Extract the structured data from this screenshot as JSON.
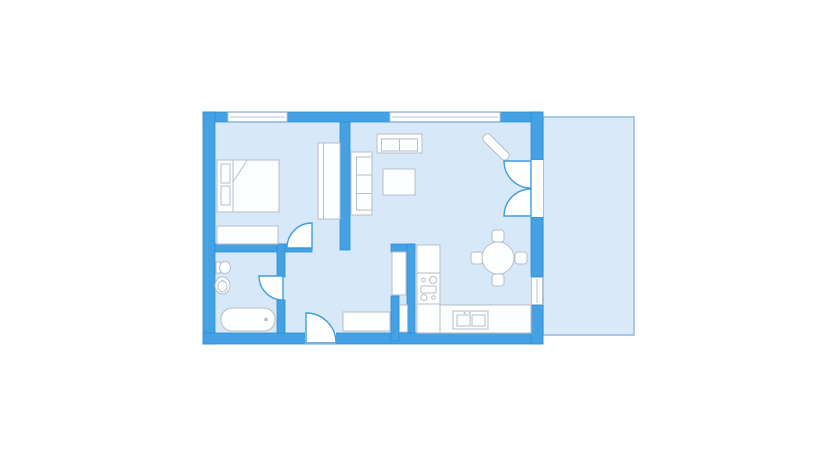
{
  "canvas": {
    "width": 834,
    "height": 460,
    "background": "#ffffff"
  },
  "palette": {
    "wall": "#45a1e1",
    "wallStroke": "#2b90d9",
    "floor": "#d7e9f8",
    "balconyFill": "#dbeaf9",
    "balconyStroke": "#93b7db",
    "white": "#ffffff",
    "furnFill": "#fdfefe",
    "furnStroke": "#b6bec9",
    "windowStroke": "#b3c3d4",
    "doorStroke": "#3f9cde"
  },
  "plan": {
    "elements": [
      {
        "kind": "rect",
        "name": "balcony-floor",
        "fill": "balconyFill",
        "stroke": "balconyStroke",
        "sw": 1.5,
        "attrs": {
          "x": 543,
          "y": 117,
          "width": 91,
          "height": 218
        }
      },
      {
        "kind": "rect",
        "name": "apartment-floor",
        "fill": "floor",
        "attrs": {
          "x": 203,
          "y": 112,
          "width": 340,
          "height": 232
        }
      },
      {
        "kind": "rect",
        "name": "wall-top",
        "fill": "wall",
        "stroke": "wallStroke",
        "sw": 0.8,
        "attrs": {
          "x": 203,
          "y": 112,
          "width": 340,
          "height": 10
        }
      },
      {
        "kind": "rect",
        "name": "wall-left",
        "fill": "wall",
        "stroke": "wallStroke",
        "sw": 0.8,
        "attrs": {
          "x": 203,
          "y": 112,
          "width": 12,
          "height": 232
        }
      },
      {
        "kind": "rect",
        "name": "wall-bottom",
        "fill": "wall",
        "stroke": "wallStroke",
        "sw": 0.8,
        "attrs": {
          "x": 203,
          "y": 333,
          "width": 340,
          "height": 11
        }
      },
      {
        "kind": "rect",
        "name": "wall-right-upper",
        "fill": "wall",
        "stroke": "wallStroke",
        "sw": 0.8,
        "attrs": {
          "x": 531,
          "y": 112,
          "width": 12,
          "height": 48
        }
      },
      {
        "kind": "rect",
        "name": "wall-right-mid",
        "fill": "wall",
        "stroke": "wallStroke",
        "sw": 0.8,
        "attrs": {
          "x": 531,
          "y": 217,
          "width": 12,
          "height": 60
        }
      },
      {
        "kind": "rect",
        "name": "wall-right-lower",
        "fill": "wall",
        "stroke": "wallStroke",
        "sw": 0.8,
        "attrs": {
          "x": 531,
          "y": 305,
          "width": 12,
          "height": 39
        }
      },
      {
        "kind": "rect",
        "name": "wall-bedroom-divider",
        "fill": "wall",
        "stroke": "wallStroke",
        "sw": 0.8,
        "attrs": {
          "x": 340,
          "y": 122,
          "width": 10,
          "height": 128
        }
      },
      {
        "kind": "rect",
        "name": "wall-bedroom-south",
        "fill": "wall",
        "stroke": "wallStroke",
        "sw": 0.8,
        "attrs": {
          "x": 215,
          "y": 244,
          "width": 97,
          "height": 8
        }
      },
      {
        "kind": "rect",
        "name": "wall-bathroom-east-upper",
        "fill": "wall",
        "stroke": "wallStroke",
        "sw": 0.8,
        "attrs": {
          "x": 277,
          "y": 244,
          "width": 8,
          "height": 33
        }
      },
      {
        "kind": "rect",
        "name": "wall-bathroom-east-lower",
        "fill": "wall",
        "stroke": "wallStroke",
        "sw": 0.8,
        "attrs": {
          "x": 277,
          "y": 300,
          "width": 8,
          "height": 33
        }
      },
      {
        "kind": "rect",
        "name": "wall-closet-north",
        "fill": "wall",
        "stroke": "wallStroke",
        "sw": 0.8,
        "attrs": {
          "x": 391,
          "y": 244,
          "width": 24,
          "height": 8
        }
      },
      {
        "kind": "rect",
        "name": "wall-closet-east",
        "fill": "wall",
        "stroke": "wallStroke",
        "sw": 0.8,
        "attrs": {
          "x": 407,
          "y": 244,
          "width": 8,
          "height": 89
        }
      },
      {
        "kind": "rect",
        "name": "wall-closet-west",
        "fill": "wall",
        "stroke": "wallStroke",
        "sw": 0.8,
        "attrs": {
          "x": 391,
          "y": 296,
          "width": 8,
          "height": 45
        }
      },
      {
        "kind": "rect",
        "name": "entrance-threshold",
        "fill": "white",
        "attrs": {
          "x": 305,
          "y": 332.5,
          "width": 31,
          "height": 11.5
        }
      },
      {
        "kind": "rect",
        "name": "balcony-threshold",
        "fill": "white",
        "attrs": {
          "x": 531,
          "y": 160,
          "width": 12,
          "height": 57
        }
      },
      {
        "kind": "rect",
        "name": "window-bedroom",
        "fill": "white",
        "stroke": "windowStroke",
        "sw": 1,
        "attrs": {
          "x": 228,
          "y": 112.5,
          "width": 59,
          "height": 9
        }
      },
      {
        "kind": "line",
        "name": "window-bedroom-glazing",
        "stroke": "windowStroke",
        "sw": 1,
        "attrs": {
          "x1": 230,
          "y1": 117,
          "x2": 285,
          "y2": 117
        }
      },
      {
        "kind": "rect",
        "name": "window-living",
        "fill": "white",
        "stroke": "windowStroke",
        "sw": 1,
        "attrs": {
          "x": 390,
          "y": 112.5,
          "width": 110,
          "height": 9
        }
      },
      {
        "kind": "line",
        "name": "window-living-glazing",
        "stroke": "windowStroke",
        "sw": 1,
        "attrs": {
          "x1": 392,
          "y1": 117,
          "x2": 498,
          "y2": 117
        }
      },
      {
        "kind": "rect",
        "name": "window-kitchen",
        "fill": "white",
        "stroke": "windowStroke",
        "sw": 1,
        "attrs": {
          "x": 531.5,
          "y": 277.5,
          "width": 11,
          "height": 27
        }
      },
      {
        "kind": "line",
        "name": "window-kitchen-glazing",
        "stroke": "windowStroke",
        "sw": 1,
        "attrs": {
          "x1": 537,
          "y1": 279,
          "x2": 537,
          "y2": 303
        }
      },
      {
        "kind": "rect",
        "name": "bed",
        "fill": "furnFill",
        "stroke": "furnStroke",
        "sw": 1,
        "attrs": {
          "x": 217,
          "y": 160,
          "width": 62,
          "height": 52
        }
      },
      {
        "kind": "line",
        "name": "bed-headboard-line",
        "stroke": "furnStroke",
        "sw": 1,
        "attrs": {
          "x1": 233,
          "y1": 160,
          "x2": 233,
          "y2": 212
        }
      },
      {
        "kind": "line",
        "name": "bed-blanket-fold",
        "stroke": "furnStroke",
        "sw": 1,
        "attrs": {
          "x1": 247,
          "y1": 160.5,
          "x2": 233,
          "y2": 182
        }
      },
      {
        "kind": "rect",
        "name": "bed-pillow-1",
        "fill": "furnFill",
        "stroke": "furnStroke",
        "sw": 1,
        "attrs": {
          "x": 221,
          "y": 164,
          "width": 9,
          "height": 19
        }
      },
      {
        "kind": "rect",
        "name": "bed-pillow-2",
        "fill": "furnFill",
        "stroke": "furnStroke",
        "sw": 1,
        "attrs": {
          "x": 221,
          "y": 186,
          "width": 9,
          "height": 19
        }
      },
      {
        "kind": "rect",
        "name": "bedroom-dresser",
        "fill": "furnFill",
        "stroke": "furnStroke",
        "sw": 1,
        "attrs": {
          "x": 217,
          "y": 226,
          "width": 61,
          "height": 18
        }
      },
      {
        "kind": "rect",
        "name": "wardrobe",
        "fill": "furnFill",
        "stroke": "furnStroke",
        "sw": 1,
        "attrs": {
          "x": 318,
          "y": 143,
          "width": 22,
          "height": 76
        }
      },
      {
        "kind": "line",
        "name": "wardrobe-door-line",
        "stroke": "furnStroke",
        "sw": 1,
        "attrs": {
          "x1": 323.5,
          "y1": 143,
          "x2": 323.5,
          "y2": 219
        }
      },
      {
        "kind": "rect",
        "name": "tv-console",
        "fill": "furnFill",
        "stroke": "furnStroke",
        "sw": 1,
        "attrs": {
          "x": 377,
          "y": 134,
          "width": 45,
          "height": 19
        }
      },
      {
        "kind": "rect",
        "name": "tv-console-inner",
        "fill": "furnFill",
        "stroke": "furnStroke",
        "sw": 1,
        "attrs": {
          "x": 381.5,
          "y": 139,
          "width": 36,
          "height": 12
        }
      },
      {
        "kind": "line",
        "name": "tv-console-divider",
        "stroke": "furnStroke",
        "sw": 1,
        "attrs": {
          "x1": 399.5,
          "y1": 139,
          "x2": 399.5,
          "y2": 151
        }
      },
      {
        "kind": "rect",
        "name": "sofa",
        "fill": "furnFill",
        "stroke": "furnStroke",
        "sw": 1,
        "attrs": {
          "x": 351,
          "y": 152,
          "width": 21,
          "height": 63
        }
      },
      {
        "kind": "rect",
        "name": "sofa-seat",
        "fill": "furnFill",
        "stroke": "furnStroke",
        "sw": 1,
        "attrs": {
          "x": 356.5,
          "y": 157,
          "width": 15.5,
          "height": 53
        }
      },
      {
        "kind": "line",
        "name": "sofa-cushion-line-1",
        "stroke": "furnStroke",
        "sw": 1,
        "attrs": {
          "x1": 356.5,
          "y1": 175,
          "x2": 372,
          "y2": 175
        }
      },
      {
        "kind": "line",
        "name": "sofa-cushion-line-2",
        "stroke": "furnStroke",
        "sw": 1,
        "attrs": {
          "x1": 356.5,
          "y1": 193.5,
          "x2": 372,
          "y2": 193.5
        }
      },
      {
        "kind": "rect",
        "name": "coffee-table",
        "fill": "furnFill",
        "stroke": "furnStroke",
        "sw": 1,
        "attrs": {
          "x": 383,
          "y": 169,
          "width": 32,
          "height": 26
        }
      },
      {
        "kind": "rect",
        "name": "corner-bench-diagonal",
        "fill": "furnFill",
        "stroke": "furnStroke",
        "sw": 1,
        "attrs": {
          "x": 479.5,
          "y": 142.5,
          "width": 33,
          "height": 9,
          "rx": 4,
          "transform": "rotate(45 496 147)"
        }
      },
      {
        "kind": "rect",
        "name": "dining-chair-north",
        "fill": "furnFill",
        "stroke": "furnStroke",
        "sw": 1,
        "attrs": {
          "x": 492,
          "y": 230,
          "width": 12,
          "height": 12,
          "rx": 3
        }
      },
      {
        "kind": "rect",
        "name": "dining-chair-south",
        "fill": "furnFill",
        "stroke": "furnStroke",
        "sw": 1,
        "attrs": {
          "x": 492,
          "y": 274,
          "width": 12,
          "height": 12,
          "rx": 3
        }
      },
      {
        "kind": "rect",
        "name": "dining-chair-west",
        "fill": "furnFill",
        "stroke": "furnStroke",
        "sw": 1,
        "attrs": {
          "x": 471,
          "y": 252,
          "width": 12,
          "height": 12,
          "rx": 3
        }
      },
      {
        "kind": "rect",
        "name": "dining-chair-east",
        "fill": "furnFill",
        "stroke": "furnStroke",
        "sw": 1,
        "attrs": {
          "x": 515,
          "y": 252,
          "width": 12,
          "height": 12,
          "rx": 3
        }
      },
      {
        "kind": "circle",
        "name": "dining-table",
        "fill": "furnFill",
        "stroke": "furnStroke",
        "sw": 1,
        "attrs": {
          "cx": 498,
          "cy": 258,
          "r": 16
        }
      },
      {
        "kind": "rect",
        "name": "fridge",
        "fill": "furnFill",
        "stroke": "furnStroke",
        "sw": 1,
        "attrs": {
          "x": 417,
          "y": 245,
          "width": 23,
          "height": 28
        }
      },
      {
        "kind": "rect",
        "name": "stove",
        "fill": "furnFill",
        "stroke": "furnStroke",
        "sw": 1,
        "attrs": {
          "x": 417,
          "y": 273,
          "width": 23,
          "height": 31
        }
      },
      {
        "kind": "circle",
        "name": "stove-burner-large-1",
        "fill": "furnFill",
        "stroke": "furnStroke",
        "sw": 1,
        "attrs": {
          "cx": 433,
          "cy": 280,
          "r": 3.5
        }
      },
      {
        "kind": "circle",
        "name": "stove-burner-small-1",
        "fill": "furnFill",
        "stroke": "furnStroke",
        "sw": 1,
        "attrs": {
          "cx": 423.5,
          "cy": 280,
          "r": 1.8
        }
      },
      {
        "kind": "rect",
        "name": "stove-oven",
        "fill": "furnFill",
        "stroke": "furnStroke",
        "sw": 1,
        "attrs": {
          "x": 421,
          "y": 286,
          "width": 15,
          "height": 7,
          "rx": 1
        }
      },
      {
        "kind": "circle",
        "name": "stove-burner-large-2",
        "fill": "furnFill",
        "stroke": "furnStroke",
        "sw": 1,
        "attrs": {
          "cx": 424,
          "cy": 297.5,
          "r": 3
        }
      },
      {
        "kind": "circle",
        "name": "stove-burner-small-2",
        "fill": "furnFill",
        "stroke": "furnStroke",
        "sw": 1,
        "attrs": {
          "cx": 433.5,
          "cy": 297.5,
          "r": 1.8
        }
      },
      {
        "kind": "rect",
        "name": "kitchen-base-cabinet",
        "fill": "furnFill",
        "stroke": "furnStroke",
        "sw": 1,
        "attrs": {
          "x": 417,
          "y": 304,
          "width": 23,
          "height": 29
        }
      },
      {
        "kind": "rect",
        "name": "kitchen-counter",
        "fill": "furnFill",
        "stroke": "furnStroke",
        "sw": 1,
        "attrs": {
          "x": 440,
          "y": 305,
          "width": 91,
          "height": 28
        }
      },
      {
        "kind": "rect",
        "name": "kitchen-sink-unit",
        "fill": "furnFill",
        "stroke": "furnStroke",
        "sw": 1,
        "attrs": {
          "x": 453,
          "y": 311,
          "width": 35,
          "height": 18
        }
      },
      {
        "kind": "rect",
        "name": "kitchen-sink-basin-1",
        "fill": "furnFill",
        "stroke": "furnStroke",
        "sw": 1,
        "attrs": {
          "x": 457,
          "y": 315,
          "width": 13,
          "height": 11
        }
      },
      {
        "kind": "rect",
        "name": "kitchen-sink-basin-2",
        "fill": "furnFill",
        "stroke": "furnStroke",
        "sw": 1,
        "attrs": {
          "x": 472,
          "y": 315,
          "width": 13,
          "height": 11
        }
      },
      {
        "kind": "circle",
        "name": "kitchen-faucet-dot-1",
        "fill": "furnStroke",
        "attrs": {
          "cx": 464.5,
          "cy": 313,
          "r": 1
        }
      },
      {
        "kind": "circle",
        "name": "kitchen-faucet-dot-2",
        "fill": "furnStroke",
        "attrs": {
          "cx": 470,
          "cy": 313,
          "r": 1
        }
      },
      {
        "kind": "rect",
        "name": "hall-sideboard",
        "fill": "furnFill",
        "stroke": "furnStroke",
        "sw": 1,
        "attrs": {
          "x": 343,
          "y": 312,
          "width": 47,
          "height": 19
        }
      },
      {
        "kind": "rect",
        "name": "hall-closet-upper",
        "fill": "furnFill",
        "stroke": "furnStroke",
        "sw": 1,
        "attrs": {
          "x": 392,
          "y": 252,
          "width": 14,
          "height": 43
        }
      },
      {
        "kind": "rect",
        "name": "hall-closet-lower",
        "fill": "furnFill",
        "stroke": "furnStroke",
        "sw": 1,
        "attrs": {
          "x": 399.5,
          "y": 305,
          "width": 8,
          "height": 27
        }
      },
      {
        "kind": "rect",
        "name": "toilet-tank",
        "fill": "furnFill",
        "stroke": "furnStroke",
        "sw": 1,
        "attrs": {
          "x": 216,
          "y": 262,
          "width": 4.5,
          "height": 11
        }
      },
      {
        "kind": "ellipse",
        "name": "toilet-bowl",
        "fill": "furnFill",
        "stroke": "furnStroke",
        "sw": 1,
        "attrs": {
          "cx": 225,
          "cy": 267.5,
          "rx": 5.5,
          "ry": 6
        }
      },
      {
        "kind": "ellipse",
        "name": "bath-basin-outer",
        "fill": "furnFill",
        "stroke": "furnStroke",
        "sw": 1,
        "attrs": {
          "cx": 222.5,
          "cy": 285.5,
          "rx": 7.5,
          "ry": 8.5
        }
      },
      {
        "kind": "ellipse",
        "name": "bath-basin-inner",
        "fill": "furnFill",
        "stroke": "furnStroke",
        "sw": 1,
        "attrs": {
          "cx": 222.5,
          "cy": 286.5,
          "rx": 4.5,
          "ry": 5.5
        }
      },
      {
        "kind": "circle",
        "name": "bath-basin-faucet-dot",
        "fill": "furnStroke",
        "attrs": {
          "cx": 222.5,
          "cy": 280.5,
          "r": 1
        }
      },
      {
        "kind": "rect",
        "name": "bathtub",
        "fill": "furnFill",
        "stroke": "furnStroke",
        "sw": 1,
        "attrs": {
          "x": 221,
          "y": 308,
          "width": 54,
          "height": 23,
          "rx": 11
        }
      },
      {
        "kind": "circle",
        "name": "bathtub-drain",
        "fill": "furnStroke",
        "attrs": {
          "cx": 266,
          "cy": 319.5,
          "r": 1.8
        }
      },
      {
        "kind": "path",
        "name": "door-bedroom",
        "fill": "white",
        "stroke": "doorStroke",
        "sw": 1.4,
        "attrs": {
          "d": "M 312 248 L 287 248 A 25 25 0 0 1 312 223 Z"
        }
      },
      {
        "kind": "path",
        "name": "door-bathroom",
        "fill": "white",
        "stroke": "doorStroke",
        "sw": 1.4,
        "attrs": {
          "d": "M 283 276 L 259 276 A 24 24 0 0 0 283 300 Z"
        }
      },
      {
        "kind": "path",
        "name": "door-entrance",
        "fill": "white",
        "stroke": "doorStroke",
        "sw": 1.4,
        "attrs": {
          "d": "M 306 343 L 306 313 A 30 30 0 0 1 336 343 Z"
        }
      },
      {
        "kind": "path",
        "name": "door-balcony-top-leaf",
        "fill": "white",
        "stroke": "doorStroke",
        "sw": 1.4,
        "attrs": {
          "d": "M 531 161 L 504 161 A 27 27 0 0 0 531 188 Z"
        }
      },
      {
        "kind": "path",
        "name": "door-balcony-bottom-leaf",
        "fill": "white",
        "stroke": "doorStroke",
        "sw": 1.4,
        "attrs": {
          "d": "M 531 216 L 504 216 A 27 27 0 0 1 531 189 Z"
        }
      }
    ]
  }
}
